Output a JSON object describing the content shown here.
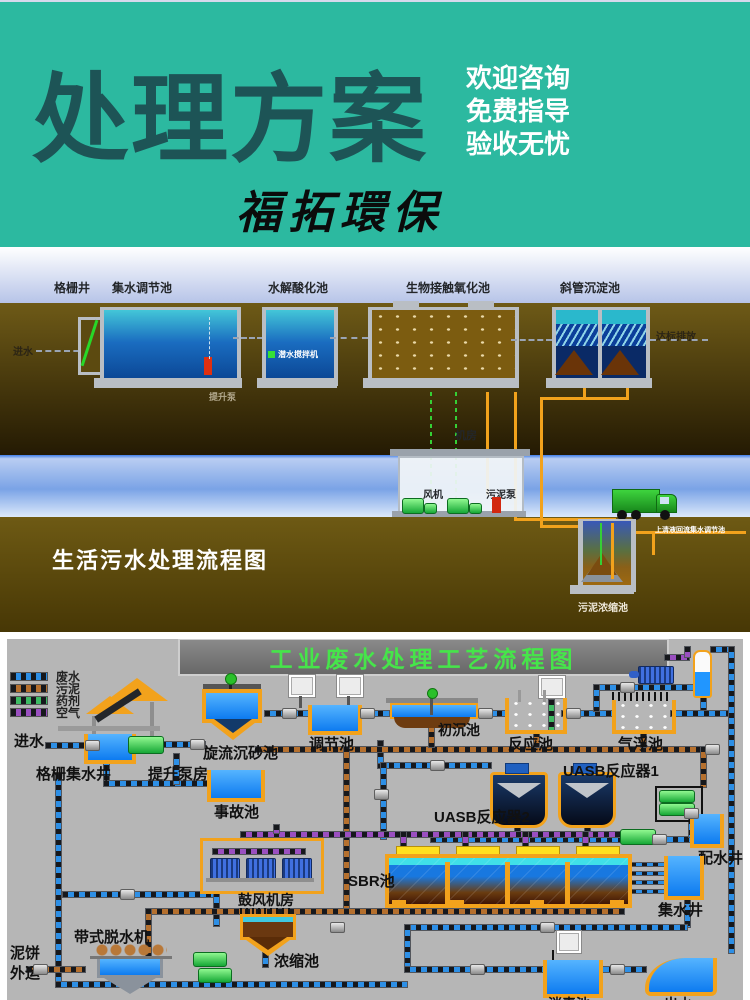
{
  "header": {
    "title": "处理方案",
    "slogans": [
      "欢迎咨询",
      "免费指导",
      "验收无忧"
    ],
    "brand": "福拓環保",
    "bg_color": "#2cb9a0",
    "title_color": "#1d5456"
  },
  "diagram1": {
    "title": "生活污水处理流程图",
    "top_labels": [
      "格栅井",
      "集水调节池",
      "水解酸化池",
      "生物接触氧化池",
      "斜管沉淀池"
    ],
    "inlet": "进水",
    "outlet": "达标排放",
    "submersible_mixer": "潜水搅拌机",
    "lift_pump": "提升泵",
    "machine_room": "机房",
    "fan": "风机",
    "sludge_pump": "污泥泵",
    "supernatant_return": "上清液回流集水调节池",
    "sludge_thickener": "污泥浓缩池"
  },
  "diagram2": {
    "title": "工业废水处理工艺流程图",
    "title_color": "#46e54a",
    "legend": [
      {
        "label": "废水",
        "color": "#2d8fe6"
      },
      {
        "label": "污泥",
        "color": "#b5702e"
      },
      {
        "label": "药剂",
        "color": "#3dbb63"
      },
      {
        "label": "空气",
        "color": "#9a4fc0"
      }
    ],
    "labels": {
      "inlet": "进水",
      "grid_well": "格栅集水井",
      "pump_house": "提升泵房",
      "cyclone": "旋流沉砂池",
      "accident_tank": "事故池",
      "regulating_tank": "调节池",
      "primary_tank": "初沉池",
      "reaction_tank": "反应池",
      "flotation_tank": "气浮池",
      "uasb1": "UASB反应器1",
      "uasb2": "UASB反应器2",
      "sbr": "SBR池",
      "distribution_well": "配水井",
      "collecting_well": "集水井",
      "blower_room": "鼓风机房",
      "belt_dewaterer": "带式脱水机",
      "thickener": "浓缩池",
      "mud_cake_line1": "泥饼",
      "mud_cake_line2": "外运",
      "disinfection_tank": "消毒池",
      "outflow": "出水"
    }
  }
}
